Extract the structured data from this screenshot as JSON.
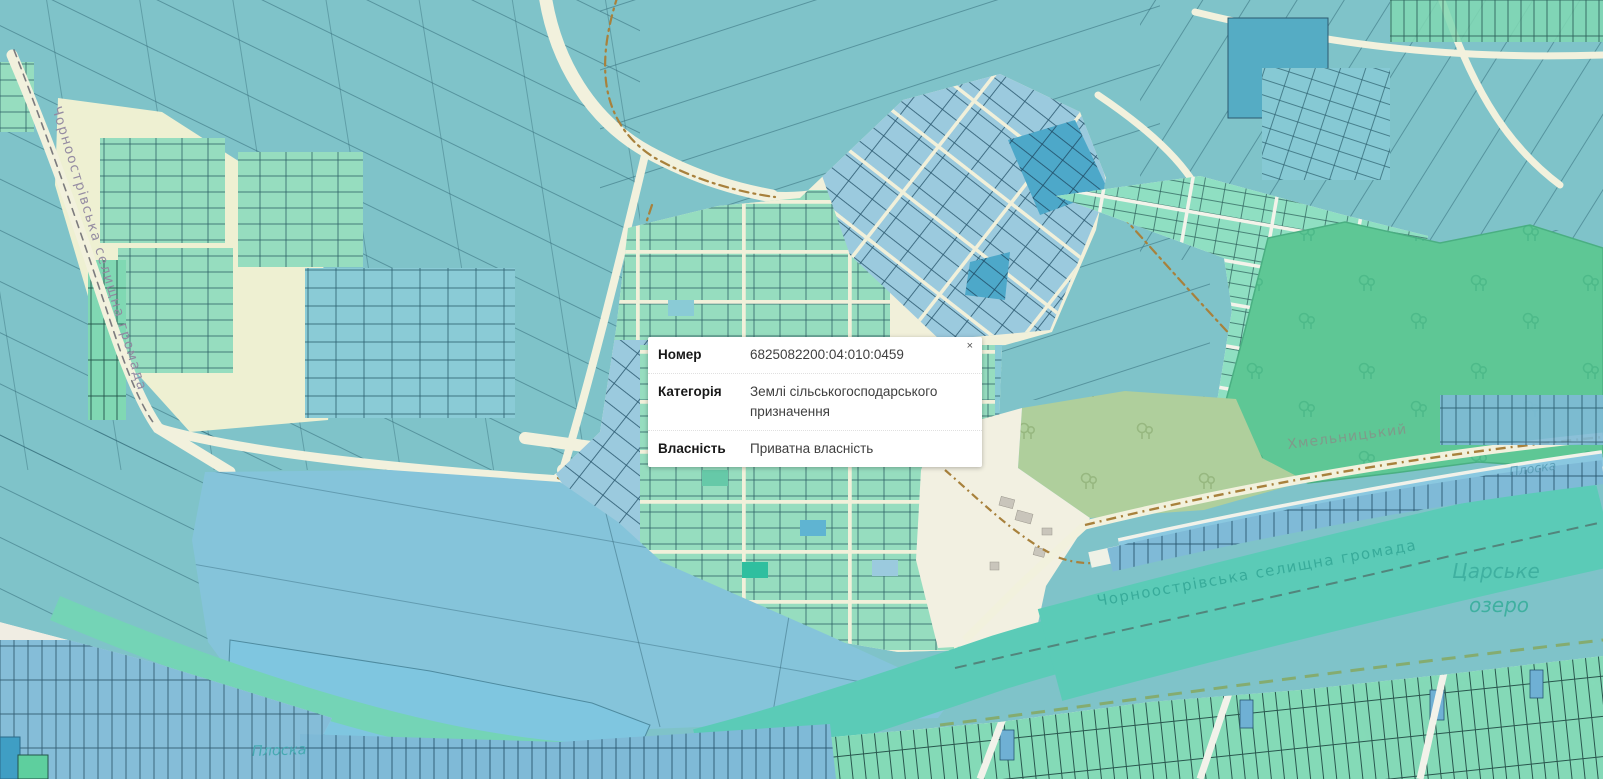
{
  "popup": {
    "close_label": "×",
    "rows": [
      {
        "label": "Номер",
        "value": "6825082200:04:010:0459"
      },
      {
        "label": "Категорія",
        "value": "Землі сільськогосподарського призначення"
      },
      {
        "label": "Власність",
        "value": "Приватна власність"
      }
    ]
  },
  "map_labels": {
    "left_road": "Чорноострівська селищна громада",
    "hromada_band": "Чорноострівська селищна громада",
    "road_right": "Хмельницький",
    "river_right": "Плоска",
    "river_bottom": "Плоска",
    "lake_line1": "Царське",
    "lake_line2": "озеро"
  },
  "colors": {
    "base_teal": "#7fc3c9",
    "parcel_mint": "#96ddbf",
    "parcel_blue": "#9bcade",
    "parcel_blue_dark": "#4da8c9",
    "forest_green": "#5ec795",
    "road_cream": "#f1f0da",
    "river_teal": "#5bcbb7",
    "water_blue": "#85c4da",
    "track_brown": "#a8813c"
  }
}
